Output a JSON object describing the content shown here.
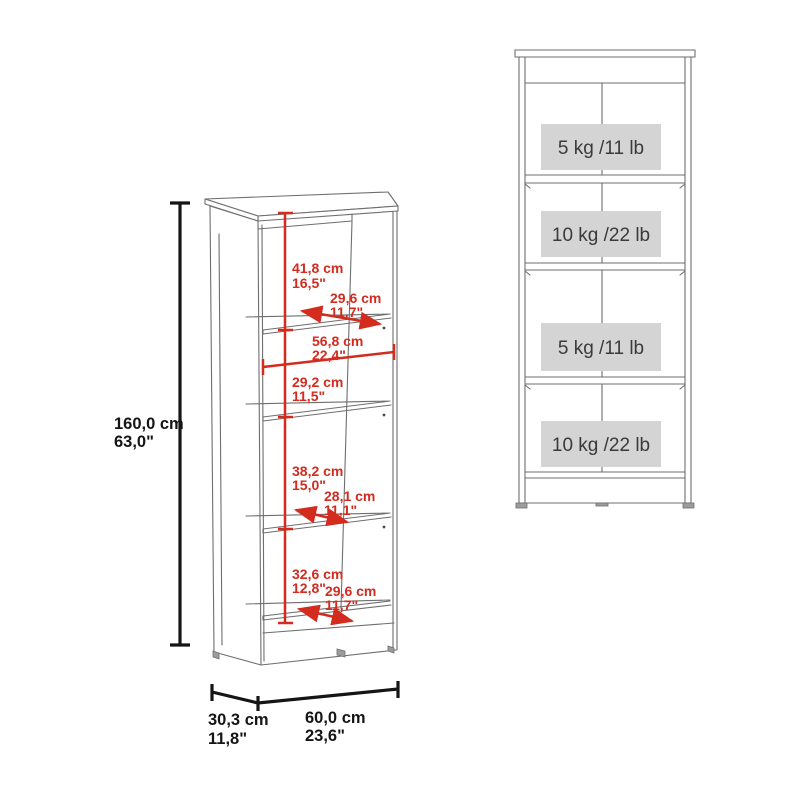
{
  "perspective_view": {
    "overall": {
      "height": {
        "cm": "160,0 cm",
        "inches": "63,0\""
      },
      "depth": {
        "cm": "30,3 cm",
        "inches": "11,8\""
      },
      "width": {
        "cm": "60,0 cm",
        "inches": "23,6\""
      }
    },
    "interior": [
      {
        "label": "top-compartment-height",
        "cm": "41,8 cm",
        "inches": "16,5\""
      },
      {
        "label": "top-shelf-depth",
        "cm": "29,6 cm",
        "inches": "11,7\""
      },
      {
        "label": "interior-width",
        "cm": "56,8 cm",
        "inches": "22,4\""
      },
      {
        "label": "second-compartment-height",
        "cm": "29,2 cm",
        "inches": "11,5\""
      },
      {
        "label": "third-compartment-height",
        "cm": "38,2 cm",
        "inches": "15,0\""
      },
      {
        "label": "middle-shelf-depth",
        "cm": "28,1 cm",
        "inches": "11,1\""
      },
      {
        "label": "bottom-compartment-height",
        "cm": "32,6 cm",
        "inches": "12,8\""
      },
      {
        "label": "bottom-shelf-depth",
        "cm": "29,6 cm",
        "inches": "11,7\""
      }
    ]
  },
  "front_view": {
    "shelf_capacities": [
      {
        "label": "top-shelf-capacity",
        "text": "5 kg /11 lb"
      },
      {
        "label": "second-shelf-capacity",
        "text": "10 kg /22 lb"
      },
      {
        "label": "third-shelf-capacity",
        "text": "5 kg /11 lb"
      },
      {
        "label": "bottom-shelf-capacity",
        "text": "10 kg /22 lb"
      }
    ]
  },
  "colors": {
    "dimension_red": "#d32b1e",
    "dimension_black": "#151515",
    "outline_gray": "#6e6e6e",
    "capacity_box_fill": "#d4d4d4",
    "capacity_text": "#3a3a3a",
    "background": "#ffffff"
  }
}
